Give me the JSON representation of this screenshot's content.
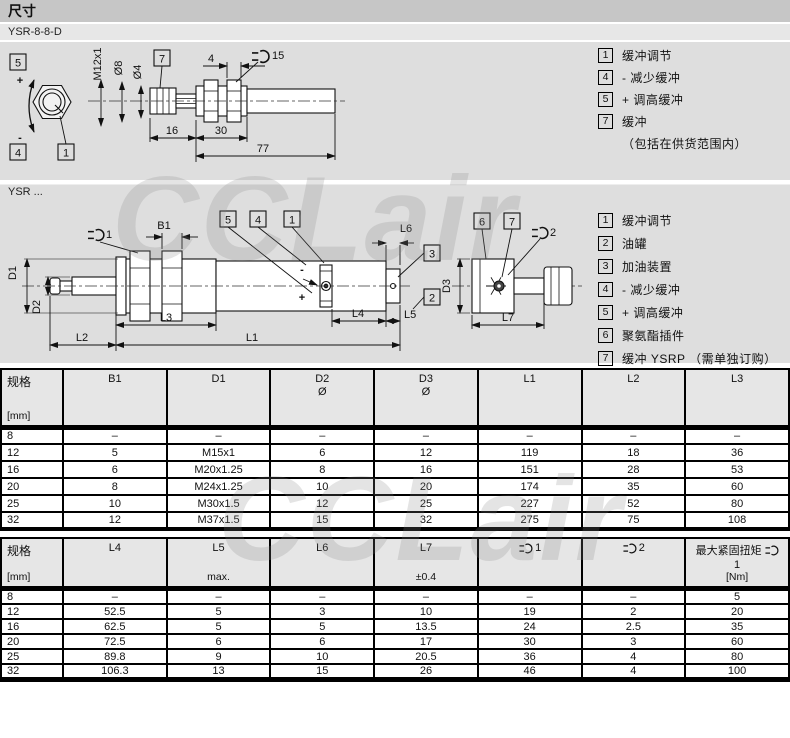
{
  "page": {
    "title": "尺寸",
    "subtitle": "YSR-8-8-D",
    "section2_label": "YSR ...",
    "watermark": "CCLair"
  },
  "drawing1": {
    "labels": {
      "box5": "5",
      "box4": "4",
      "box1": "1",
      "box7": "7",
      "plus": "+",
      "minus": "-",
      "thread": "M12x1",
      "dia_8": "Ø8",
      "dia_4": "Ø4",
      "dim_4": "4",
      "wrench_size": "15",
      "dim_16": "16",
      "dim_30": "30",
      "dim_77": "77"
    },
    "legend": [
      {
        "num": "1",
        "text": "缓冲调节"
      },
      {
        "num": "4",
        "text": "- 减少缓冲"
      },
      {
        "num": "5",
        "text": "+ 调高缓冲"
      },
      {
        "num": "7",
        "text": "缓冲"
      },
      {
        "num": "",
        "text": "（包括在供货范围内）"
      }
    ]
  },
  "drawing2": {
    "labels": {
      "wrench1_num": "1",
      "wrench2_num": "2",
      "b1": "B1",
      "d1": "D1",
      "d2": "D2",
      "d3": "D3",
      "l1": "L1",
      "l2": "L2",
      "l3": "L3",
      "l4": "L4",
      "l5": "L5",
      "l6": "L6",
      "l7": "L7",
      "box1": "1",
      "box2": "2",
      "box3": "3",
      "box4": "4",
      "box5": "5",
      "box6": "6",
      "box7": "7",
      "plus": "+",
      "minus": "-"
    },
    "legend": [
      {
        "num": "1",
        "text": "缓冲调节"
      },
      {
        "num": "2",
        "text": "油罐"
      },
      {
        "num": "3",
        "text": "加油装置"
      },
      {
        "num": "4",
        "text": "- 减少缓冲"
      },
      {
        "num": "5",
        "text": "+ 调高缓冲"
      },
      {
        "num": "6",
        "text": "聚氨酯插件"
      },
      {
        "num": "7",
        "text": "缓冲 YSRP （需单独订购）"
      }
    ]
  },
  "table1": {
    "header": {
      "spec": "规格",
      "unit": "[mm]",
      "b1": "B1",
      "d1": "D1",
      "d2": "D2",
      "d2_sub": "Ø",
      "d3": "D3",
      "d3_sub": "Ø",
      "l1": "L1",
      "l2": "L2",
      "l3": "L3"
    },
    "rows": [
      [
        "8",
        "–",
        "–",
        "–",
        "–",
        "–",
        "–",
        "–"
      ],
      [
        "12",
        "5",
        "M15x1",
        "6",
        "12",
        "119",
        "18",
        "36"
      ],
      [
        "16",
        "6",
        "M20x1.25",
        "8",
        "16",
        "151",
        "28",
        "53"
      ],
      [
        "20",
        "8",
        "M24x1.25",
        "10",
        "20",
        "174",
        "35",
        "60"
      ],
      [
        "25",
        "10",
        "M30x1.5",
        "12",
        "25",
        "227",
        "52",
        "80"
      ],
      [
        "32",
        "12",
        "M37x1.5",
        "15",
        "32",
        "275",
        "75",
        "108"
      ]
    ]
  },
  "table2": {
    "header": {
      "spec": "规格",
      "unit": "[mm]",
      "l4": "L4",
      "l5": "L5",
      "l5_sub": "max.",
      "l6": "L6",
      "l7": "L7",
      "l7_sub": "±0.4",
      "c1": "1",
      "c2": "2",
      "torque": "最大紧固扭矩",
      "torque_num": "1",
      "torque_unit": "[Nm]"
    },
    "rows": [
      [
        "8",
        "–",
        "–",
        "–",
        "–",
        "–",
        "–",
        "5"
      ],
      [
        "12",
        "52.5",
        "5",
        "3",
        "10",
        "19",
        "2",
        "20"
      ],
      [
        "16",
        "62.5",
        "5",
        "5",
        "13.5",
        "24",
        "2.5",
        "35"
      ],
      [
        "20",
        "72.5",
        "6",
        "6",
        "17",
        "30",
        "3",
        "60"
      ],
      [
        "25",
        "89.8",
        "9",
        "10",
        "20.5",
        "36",
        "4",
        "80"
      ],
      [
        "32",
        "106.3",
        "13",
        "15",
        "26",
        "46",
        "4",
        "100"
      ]
    ]
  }
}
